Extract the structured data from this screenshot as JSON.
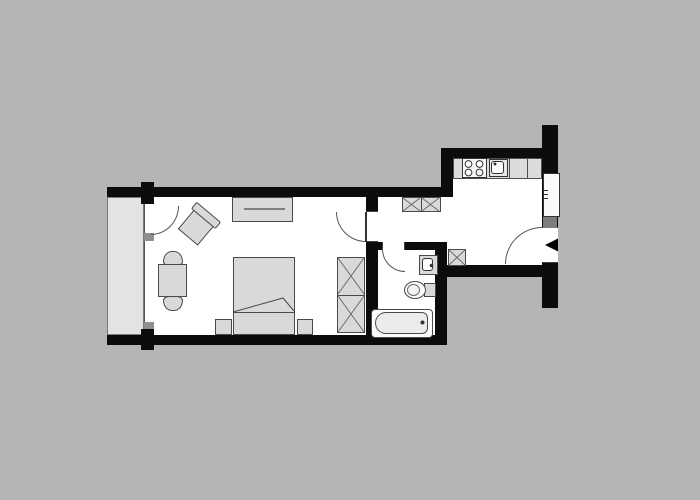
{
  "title": "apartment-floor-plan",
  "colors": {
    "background": "#b5b5b5",
    "wall": "#0c0c0c",
    "floor": "#ffffff",
    "furniture": "#d9d9d9",
    "furniture_outline": "#4a4a4a",
    "balcony": "#e3e3e3",
    "facade_post": "#8f8f8f",
    "door_frame_block": "#7d7d7d",
    "line": "#555555",
    "x_pattern": "#6b6b6b",
    "counter": "#dcdcdc",
    "arrow": "#000000"
  },
  "rooms": [
    {
      "name": "living-bedroom"
    },
    {
      "name": "entry-hall"
    },
    {
      "name": "kitchen"
    },
    {
      "name": "bathroom"
    },
    {
      "name": "balcony"
    }
  ],
  "fixtures": [
    "balcony-slab",
    "glazed-facade",
    "balcony-door",
    "sideboard",
    "armchair",
    "dining-table",
    "dining-chair-top",
    "dining-chair-bottom",
    "bed-with-duvet-fold",
    "nightstand-left",
    "nightstand-right",
    "wardrobe-2-cell",
    "hall-wardrobe-2-cell",
    "shaft-box",
    "kitchen-counter",
    "cooktop-4-burner",
    "kitchen-sink",
    "bathtub",
    "toilet",
    "washbasin",
    "room-door",
    "bathroom-door",
    "entrance-door",
    "entrance-arrow"
  ]
}
